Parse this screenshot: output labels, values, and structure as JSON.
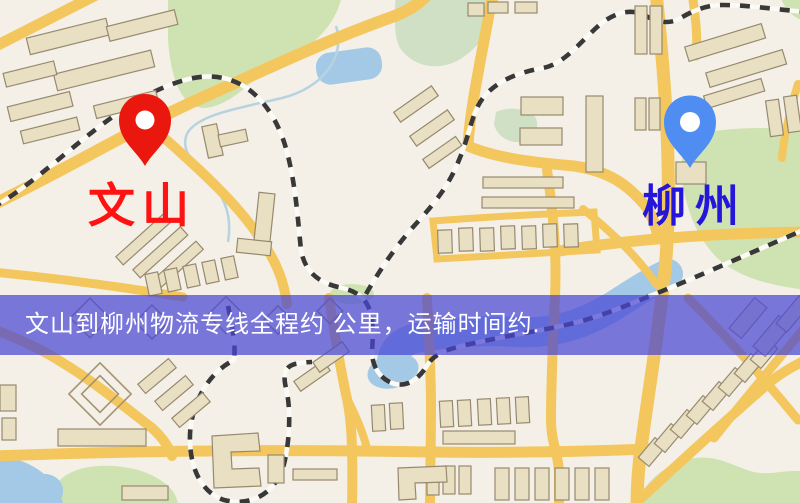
{
  "map": {
    "origin": {
      "label": "文山",
      "pin_icon": "location-pin",
      "pin_color": "#e9170d",
      "label_color": "#ff1212"
    },
    "destination": {
      "label": "柳州",
      "pin_icon": "location-pin",
      "pin_color": "#4f8df2",
      "label_color": "#2517d9"
    },
    "banner": {
      "text": "文山到柳州物流专线全程约 公里，运输时间约.",
      "background_color": "#4946d5",
      "background_opacity": "0.72",
      "text_color": "#ffffff"
    },
    "style_colors": {
      "background": "#f4f0e7",
      "road": "#f3c75d",
      "park": "#cfe3b2",
      "water": "#a3c9e6",
      "building": "#e9e0c3",
      "railway": "#383838"
    }
  }
}
